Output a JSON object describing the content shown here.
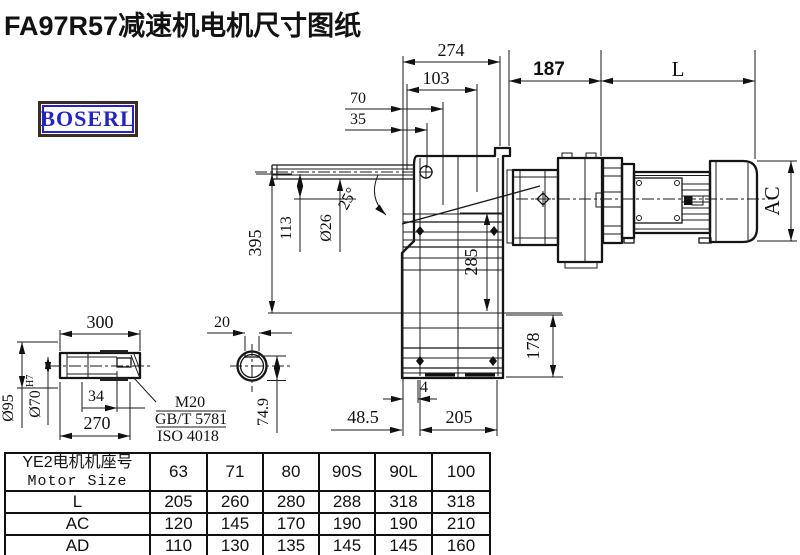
{
  "title": "FA97R57减速机电机尺寸图纸",
  "logo": {
    "text": "BOSERL"
  },
  "drawing": {
    "top_dims": {
      "d274": "274",
      "d103": "103",
      "d70": "70",
      "d35": "35",
      "d187": "187",
      "dL": "L"
    },
    "left_dims": {
      "d395": "395",
      "d113": "113",
      "d26": "Ø26",
      "angle": "25°"
    },
    "right_dims": {
      "dAC": "AC",
      "d285": "285",
      "d178": "178"
    },
    "bottom_dims": {
      "d4": "4",
      "d48_5": "48.5",
      "d205": "205"
    },
    "shaft_view": {
      "d300": "300",
      "d95": "Ø95",
      "d70": "Ø70",
      "d70_tol": "H7",
      "d34": "34",
      "d270": "270",
      "d20": "20",
      "d74_9": "74.9",
      "thread_note": {
        "line1": "M20",
        "line2": "GB/T 5781",
        "line3": "ISO 4018"
      }
    }
  },
  "table": {
    "header": {
      "cn": "YE2电机机座号",
      "en": "Motor Size"
    },
    "sizes": [
      "63",
      "71",
      "80",
      "90S",
      "90L",
      "100"
    ],
    "rows": [
      {
        "label": "L",
        "values": [
          "205",
          "260",
          "280",
          "288",
          "318",
          "318"
        ]
      },
      {
        "label": "AC",
        "values": [
          "120",
          "145",
          "170",
          "190",
          "190",
          "210"
        ]
      },
      {
        "label": "AD",
        "values": [
          "110",
          "130",
          "135",
          "145",
          "145",
          "160"
        ]
      }
    ]
  }
}
